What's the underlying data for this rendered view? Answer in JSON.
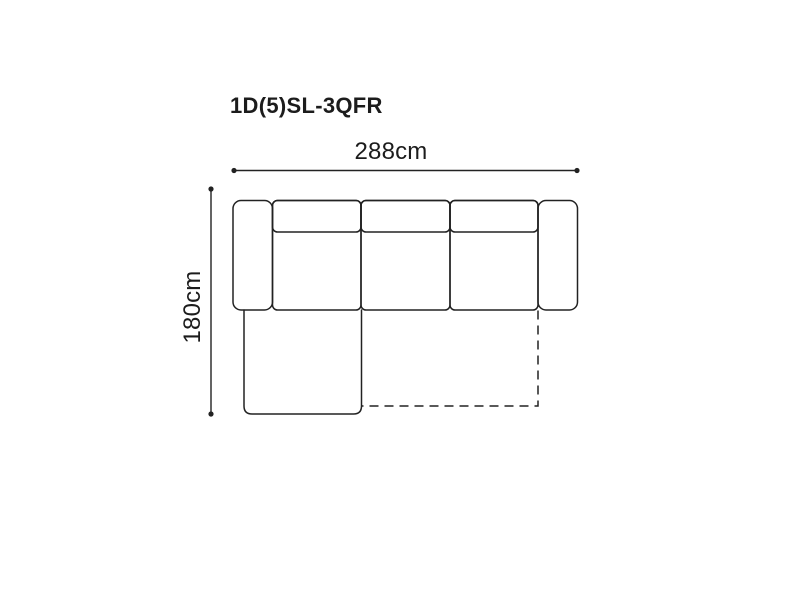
{
  "diagram": {
    "title": "1D(5)SL-3QFR",
    "dimensions": {
      "width": {
        "label": "288cm"
      },
      "height": {
        "label": "180cm"
      }
    },
    "colors": {
      "line": "#222222",
      "text": "#1c1c1c",
      "background": "#ffffff"
    },
    "drawing": {
      "type": "sofa-top-view",
      "parts": [
        "left-armrest",
        "seat-section-1",
        "seat-section-2",
        "seat-section-3",
        "back-cushion-1",
        "back-cushion-2",
        "back-cushion-3",
        "right-armrest",
        "chaise-extension",
        "fold-out-bed-dashed-outline"
      ]
    }
  }
}
